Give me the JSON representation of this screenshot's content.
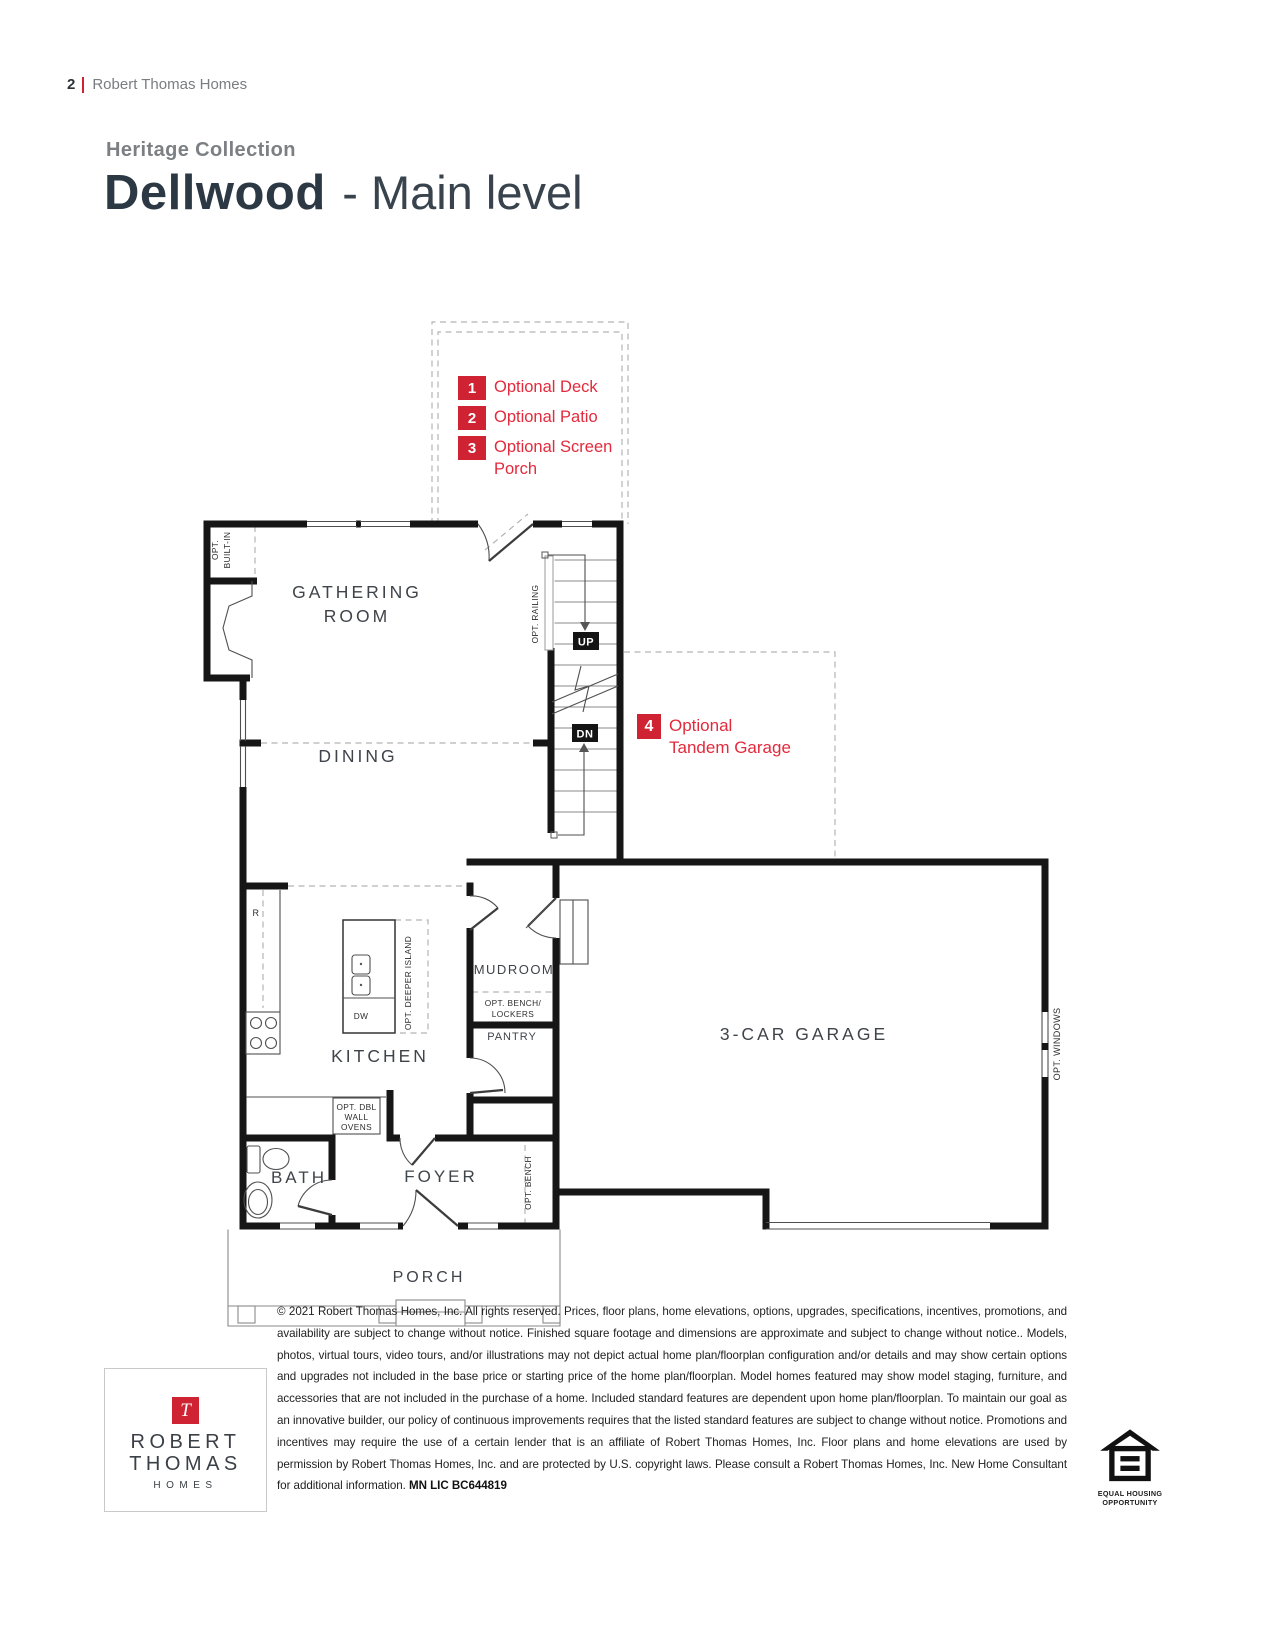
{
  "page": {
    "page_number": "2",
    "brand": "Robert Thomas Homes"
  },
  "header": {
    "collection": "Heritage Collection",
    "plan_name": "Dellwood",
    "level": "- Main level"
  },
  "legend": {
    "items": [
      {
        "num": "1",
        "line1": "Optional Deck",
        "line2": ""
      },
      {
        "num": "2",
        "line1": "Optional Patio",
        "line2": ""
      },
      {
        "num": "3",
        "line1": "Optional Screen",
        "line2": "Porch"
      },
      {
        "num": "4",
        "line1": "Optional",
        "line2": "Tandem Garage"
      }
    ]
  },
  "floorplan": {
    "rooms": {
      "gathering1": "GATHERING",
      "gathering2": "ROOM",
      "dining": "DINING",
      "kitchen": "KITCHEN",
      "mudroom": "MUDROOM",
      "pantry": "PANTRY",
      "bath": "BATH",
      "foyer": "FOYER",
      "porch": "PORCH",
      "garage": "3-CAR GARAGE"
    },
    "annotations": {
      "opt1": "OPT.",
      "built_in": "BUILT-IN",
      "opt_railing": "OPT. RAILING",
      "up": "UP",
      "dn": "DN",
      "r": "R",
      "dw": "DW",
      "opt_deeper_island": "OPT. DEEPER ISLAND",
      "opt_bench_lockers1": "OPT. BENCH/",
      "opt_bench_lockers2": "LOCKERS",
      "opt_dbl1": "OPT. DBL",
      "opt_dbl2": "WALL",
      "opt_dbl3": "OVENS",
      "opt_bench": "OPT. BENCH",
      "opt_windows": "OPT. WINDOWS"
    }
  },
  "footer": {
    "logo": {
      "initial": "T",
      "line1": "ROBERT",
      "line2": "THOMAS",
      "line3": "HOMES"
    },
    "disclaimer": "© 2021 Robert Thomas Homes, Inc. All rights reserved. Prices, floor plans, home elevations, options, upgrades, specifications, incentives, promotions, and availability are subject to change without notice. Finished square footage and dimensions are approximate and subject to change without notice.. Models, photos, virtual tours, video tours, and/or illustrations may not depict actual home plan/floorplan configuration and/or details and may show certain options and upgrades not included in the base price or starting price of the home plan/floorplan. Model homes featured may show model staging, furniture, and accessories that are not included in the purchase of a home. Included standard features are dependent upon home plan/floorplan. To maintain our goal as an innovative builder, our policy of continuous improvements requires that the listed standard features are subject to change without notice. Promotions and incentives may require the use of a certain lender that is an affiliate of Robert Thomas Homes, Inc. Floor plans and home elevations are used by permission by Robert Thomas Homes, Inc. and are protected by U.S. copyright laws. Please consult a Robert Thomas Homes, Inc. New Home Consultant for additional information. ",
    "license": "MN LIC BC644819",
    "eho1": "EQUAL HOUSING",
    "eho2": "OPPORTUNITY"
  },
  "colors": {
    "accent_red": "#cf2233",
    "legend_text_red": "#e32a3c",
    "wall_ink": "#161616",
    "room_label": "#3f444a"
  }
}
